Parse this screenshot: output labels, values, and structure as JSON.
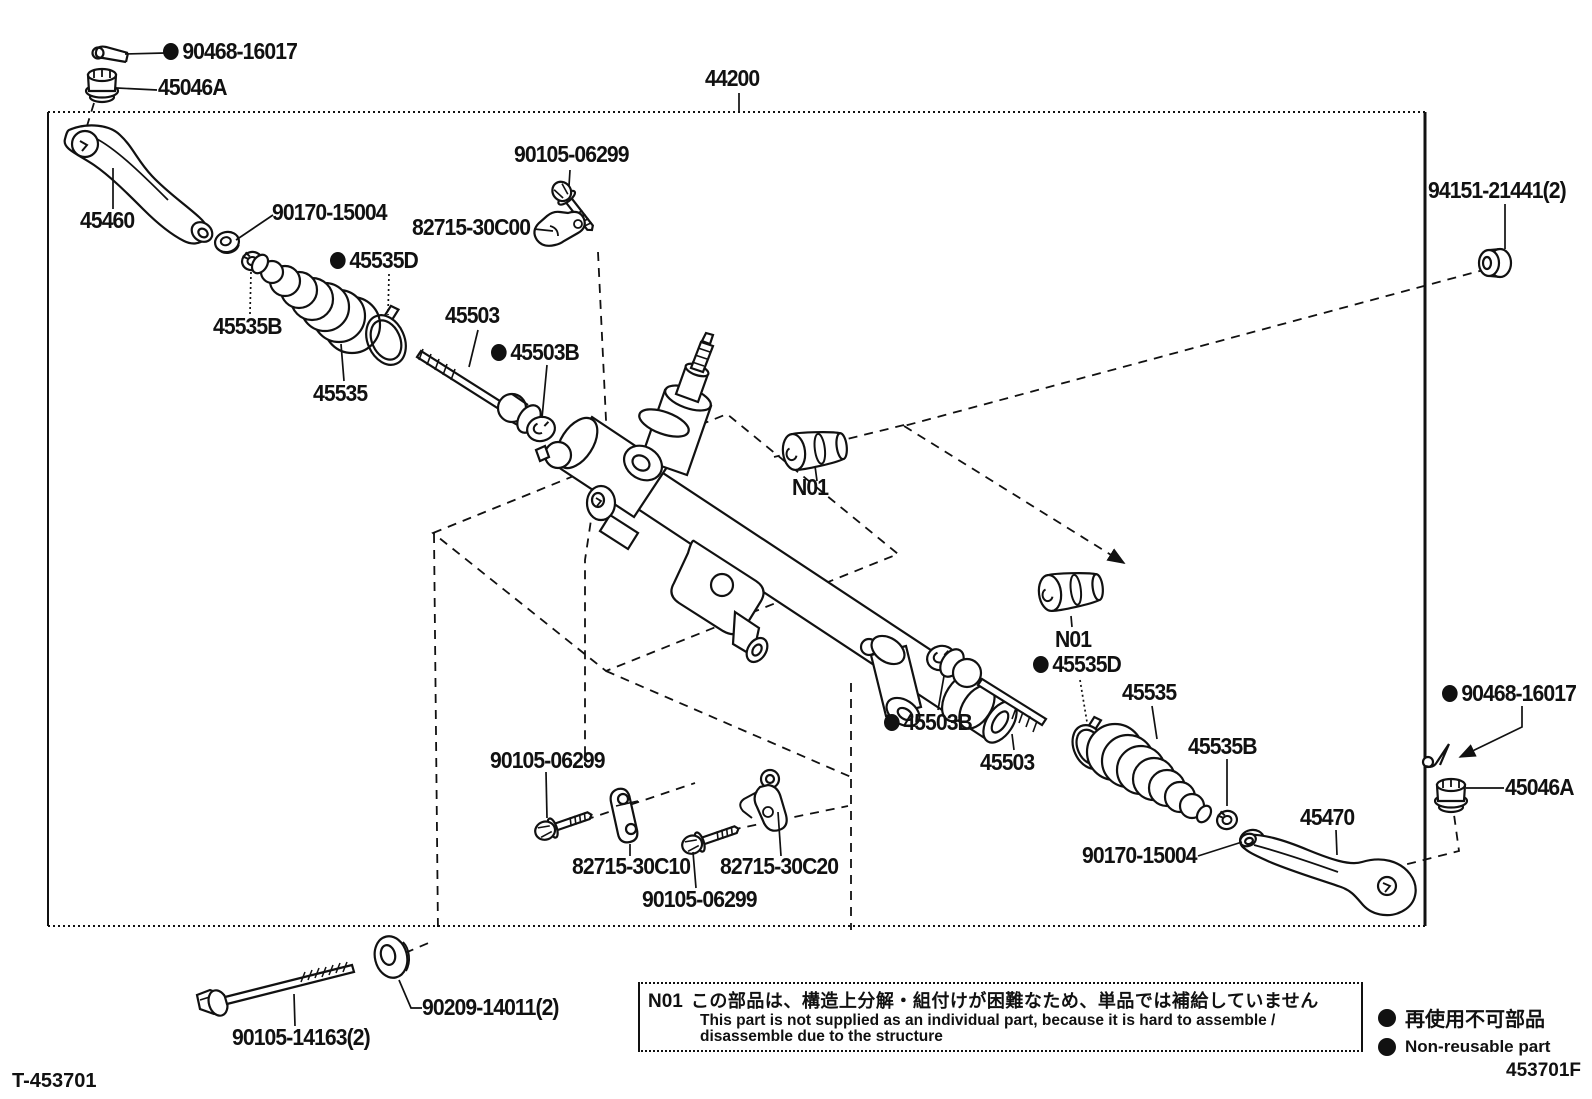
{
  "doc": {
    "footer_left": "T-453701",
    "footer_right": "453701F"
  },
  "colors": {
    "line": "#111111",
    "background": "#ffffff"
  },
  "note_box": {
    "code": "N01",
    "jp": "この部品は、構造上分解・組付けが困難なため、単品では補給していません",
    "en_line1": "This part is not supplied as an individual part, because it is hard to assemble /",
    "en_line2": "disassemble due to the structure"
  },
  "legend": {
    "jp": "再使用不可部品",
    "en": "Non-reusable part"
  },
  "labels": [
    {
      "id": "90468-16017-a",
      "text": "90468-16017",
      "dot": true,
      "x": 163,
      "y": 40
    },
    {
      "id": "45046A-a",
      "text": "45046A",
      "dot": false,
      "x": 158,
      "y": 76
    },
    {
      "id": "44200",
      "text": "44200",
      "dot": false,
      "x": 705,
      "y": 67
    },
    {
      "id": "90105-06299-a",
      "text": "90105-06299",
      "dot": false,
      "x": 514,
      "y": 143
    },
    {
      "id": "94151-21441",
      "text": "94151-21441(2)",
      "dot": false,
      "x": 1428,
      "y": 179
    },
    {
      "id": "45460",
      "text": "45460",
      "dot": false,
      "x": 80,
      "y": 209
    },
    {
      "id": "90170-15004-a",
      "text": "90170-15004",
      "dot": false,
      "x": 272,
      "y": 201
    },
    {
      "id": "82715-30C00",
      "text": "82715-30C00",
      "dot": false,
      "x": 412,
      "y": 216
    },
    {
      "id": "45535D-a",
      "text": "45535D",
      "dot": true,
      "x": 330,
      "y": 249
    },
    {
      "id": "45535B-a",
      "text": "45535B",
      "dot": false,
      "x": 213,
      "y": 315
    },
    {
      "id": "45503-a",
      "text": "45503",
      "dot": false,
      "x": 445,
      "y": 304
    },
    {
      "id": "45503B-a",
      "text": "45503B",
      "dot": true,
      "x": 491,
      "y": 341
    },
    {
      "id": "45535-a",
      "text": "45535",
      "dot": false,
      "x": 313,
      "y": 382
    },
    {
      "id": "N01-a",
      "text": "N01",
      "dot": false,
      "x": 792,
      "y": 476
    },
    {
      "id": "N01-b",
      "text": "N01",
      "dot": false,
      "x": 1055,
      "y": 628
    },
    {
      "id": "45535D-b",
      "text": "45535D",
      "dot": true,
      "x": 1033,
      "y": 653
    },
    {
      "id": "45535-b",
      "text": "45535",
      "dot": false,
      "x": 1122,
      "y": 681
    },
    {
      "id": "45503B-b",
      "text": "45503B",
      "dot": true,
      "x": 884,
      "y": 711
    },
    {
      "id": "45503-b",
      "text": "45503",
      "dot": false,
      "x": 980,
      "y": 751
    },
    {
      "id": "45535B-b",
      "text": "45535B",
      "dot": false,
      "x": 1188,
      "y": 735
    },
    {
      "id": "90105-06299-b",
      "text": "90105-06299",
      "dot": false,
      "x": 490,
      "y": 749
    },
    {
      "id": "82715-30C10",
      "text": "82715-30C10",
      "dot": false,
      "x": 572,
      "y": 855
    },
    {
      "id": "82715-30C20",
      "text": "82715-30C20",
      "dot": false,
      "x": 720,
      "y": 855
    },
    {
      "id": "90105-06299-c",
      "text": "90105-06299",
      "dot": false,
      "x": 642,
      "y": 888
    },
    {
      "id": "90170-15004-b",
      "text": "90170-15004",
      "dot": false,
      "x": 1082,
      "y": 844
    },
    {
      "id": "45470",
      "text": "45470",
      "dot": false,
      "x": 1300,
      "y": 806
    },
    {
      "id": "90468-16017-b",
      "text": "90468-16017",
      "dot": true,
      "x": 1442,
      "y": 682
    },
    {
      "id": "45046A-b",
      "text": "45046A",
      "dot": false,
      "x": 1505,
      "y": 776
    },
    {
      "id": "90209-14011",
      "text": "90209-14011(2)",
      "dot": false,
      "x": 422,
      "y": 996
    },
    {
      "id": "90105-14163",
      "text": "90105-14163(2)",
      "dot": false,
      "x": 232,
      "y": 1026
    }
  ]
}
